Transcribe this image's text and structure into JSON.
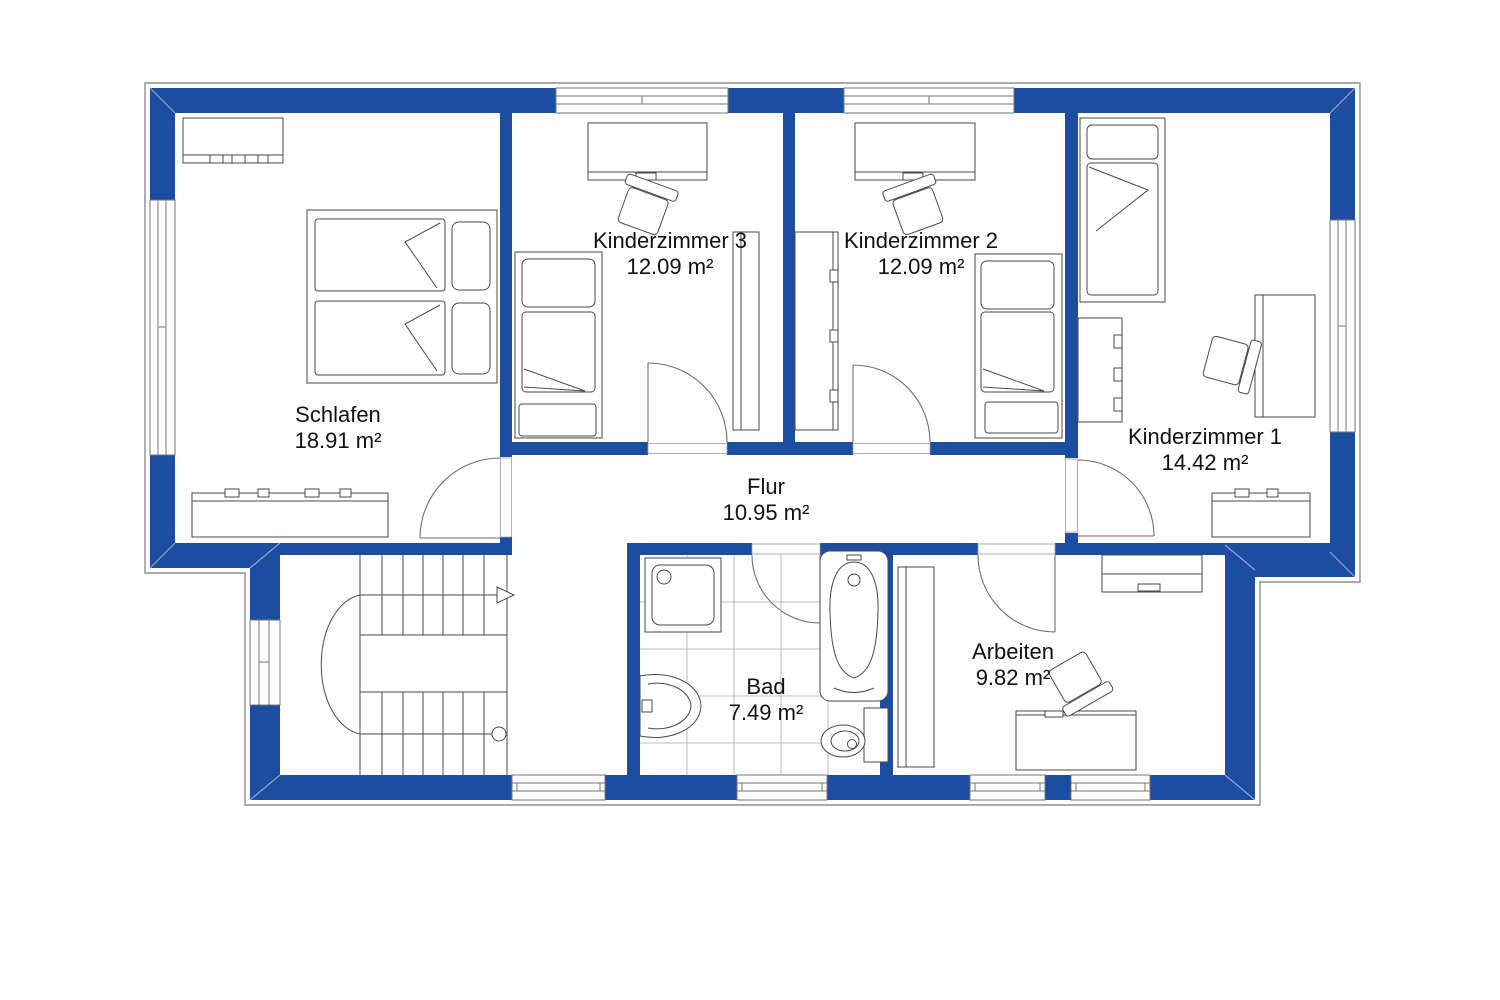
{
  "colors": {
    "wall": "#1C4DA1",
    "line": "#4a4a4a",
    "text": "#111111"
  },
  "rooms": [
    {
      "name": "Schlafen",
      "area": "18.91 m²"
    },
    {
      "name": "Kinderzimmer 3",
      "area": "12.09 m²"
    },
    {
      "name": "Kinderzimmer 2",
      "area": "12.09 m²"
    },
    {
      "name": "Kinderzimmer 1",
      "area": "14.42 m²"
    },
    {
      "name": "Flur",
      "area": "10.95 m²"
    },
    {
      "name": "Bad",
      "area": "7.49 m²"
    },
    {
      "name": "Arbeiten",
      "area": "9.82 m²"
    }
  ]
}
